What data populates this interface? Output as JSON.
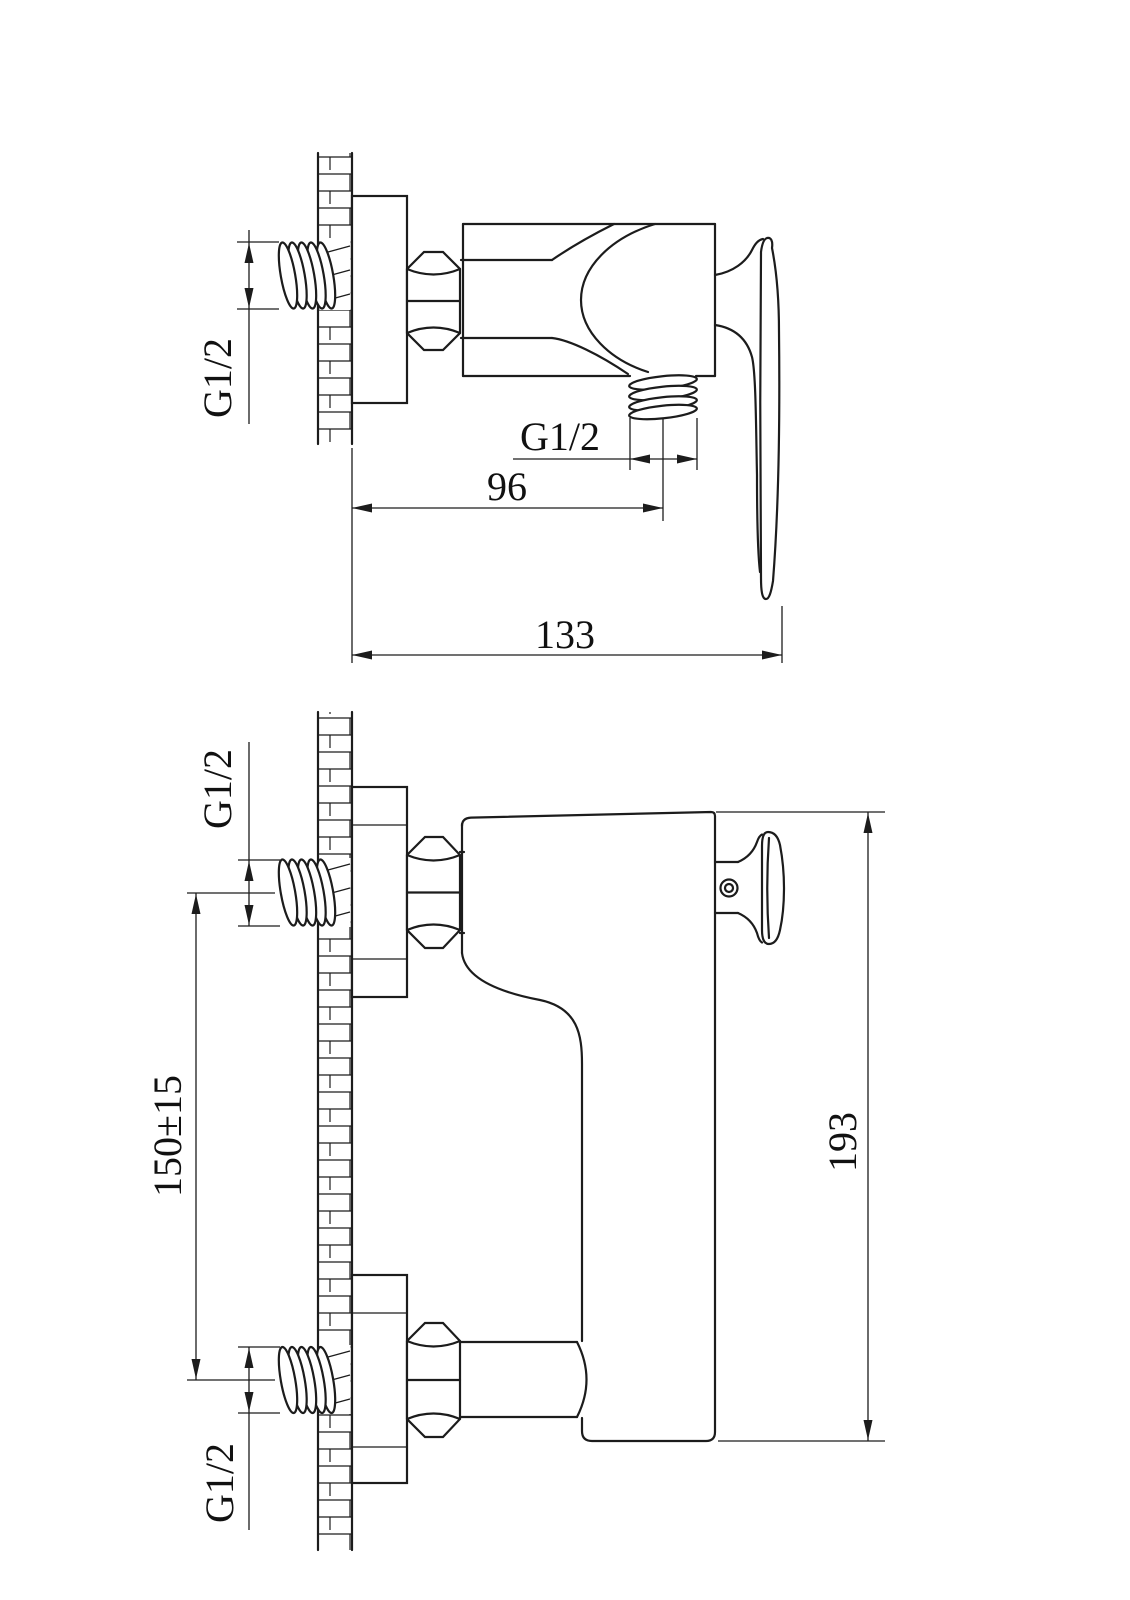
{
  "drawing": {
    "kind": "technical-drawing",
    "subject": "wall-mounted shower mixer valve, two views with dimensions",
    "background": "#ffffff",
    "line_color": "#1c1c1c",
    "top_view": {
      "inlet_thread_label": "G1/2",
      "outlet_thread_label": "G1/2",
      "wall_to_outlet_dim": "96",
      "overall_depth_dim": "133"
    },
    "bottom_view": {
      "top_inlet_thread_label": "G1/2",
      "bottom_inlet_thread_label": "G1/2",
      "inlet_spacing_dim": "150±15",
      "overall_height_dim": "193"
    }
  }
}
